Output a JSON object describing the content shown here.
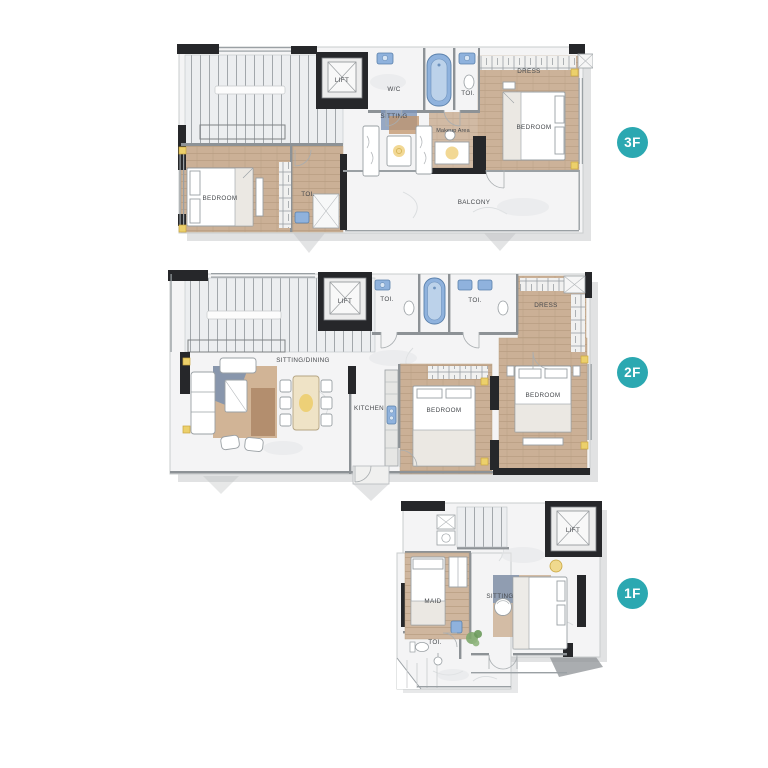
{
  "floors": [
    {
      "id": "3f",
      "badge_label": "3F",
      "rooms": {
        "lift": "LIFT",
        "wc": "W/C",
        "toi_top": "TOI.",
        "dress": "DRESS",
        "bedroom_right": "BEDROOM",
        "sitting": "SITTING",
        "makeup_area": "Makeup Area",
        "bedroom_left": "BEDROOM",
        "toi_bottom": "TOI.",
        "balcony": "BALCONY"
      }
    },
    {
      "id": "2f",
      "badge_label": "2F",
      "rooms": {
        "lift": "LIFT",
        "toi_left": "TOI.",
        "toi_right": "TOI.",
        "dress": "DRESS",
        "sitting_dining": "SITTING/DINING",
        "kitchen": "KITCHEN",
        "bedroom_middle": "BEDROOM",
        "bedroom_right": "BEDROOM"
      }
    },
    {
      "id": "1f",
      "badge_label": "1F",
      "rooms": {
        "lift": "LIFT",
        "maid": "MAID",
        "sitting": "SITTING",
        "toi": "TOI."
      }
    }
  ],
  "colors": {
    "badge_teal": "#2ba8b1",
    "wall_black": "#26272a",
    "wood": "#cbb096",
    "marble": "#f4f4f5",
    "fixture_blue": "#8fb2dd",
    "accent_gold": "#ecd06b",
    "shadow_gray": "#c3c6c8"
  }
}
